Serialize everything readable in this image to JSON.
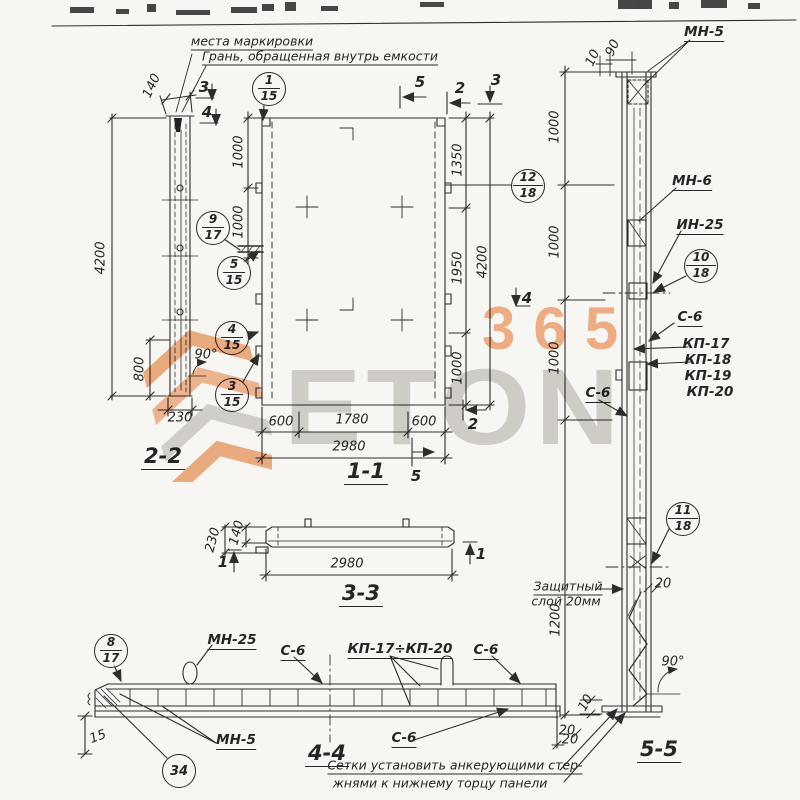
{
  "watermark": {
    "number": "365",
    "word": "ETON",
    "orange": "#f2a06f",
    "gray": "#ccc9c5"
  },
  "notes": {
    "marking1": "места маркировки",
    "marking2": "Грань, обращенная внутрь емкости",
    "protective1": "Защитный",
    "protective2": "слой 20мм",
    "bottom1": "Сетки установить анкерующими стер-",
    "bottom2": "жнями к нижнему торцу панели"
  },
  "labels": {
    "v22": "2-2",
    "v11": "1-1",
    "v33": "3-3",
    "v44": "4-4",
    "v55": "5-5"
  },
  "dims": {
    "d4200": "4200",
    "d800": "800",
    "d230": "230",
    "d140": "140",
    "d90deg": "90°",
    "d1000": "1000",
    "d1350": "1350",
    "d1950": "1950",
    "d600": "600",
    "d1780": "1780",
    "d2980": "2980",
    "d1200": "1200",
    "d90": "90",
    "d10": "10",
    "d20": "20",
    "d15": "15"
  },
  "marks": {
    "s1": "1",
    "s2": "2",
    "s3": "3",
    "s4": "4",
    "s5": "5"
  },
  "callouts": {
    "c1_15": {
      "top": "1",
      "bot": "15"
    },
    "c9_17": {
      "top": "9",
      "bot": "17"
    },
    "c5_15": {
      "top": "5",
      "bot": "15"
    },
    "c4_15": {
      "top": "4",
      "bot": "15"
    },
    "c3_15": {
      "top": "3",
      "bot": "15"
    },
    "c12_18": {
      "top": "12",
      "bot": "18"
    },
    "c10_18": {
      "top": "10",
      "bot": "18"
    },
    "c11_18": {
      "top": "11",
      "bot": "18"
    },
    "c8_17": {
      "top": "8",
      "bot": "17"
    },
    "c34": "34"
  },
  "parts": {
    "mn5": "МН-5",
    "mn6": "МН-6",
    "mn25": "МН-25",
    "in25": "ИН-25",
    "c6": "С-6",
    "kp17": "КП-17",
    "kp18": "КП-18",
    "kp19": "КП-19",
    "kp20": "КП-20",
    "kp_range": "КП-17÷КП-20"
  }
}
